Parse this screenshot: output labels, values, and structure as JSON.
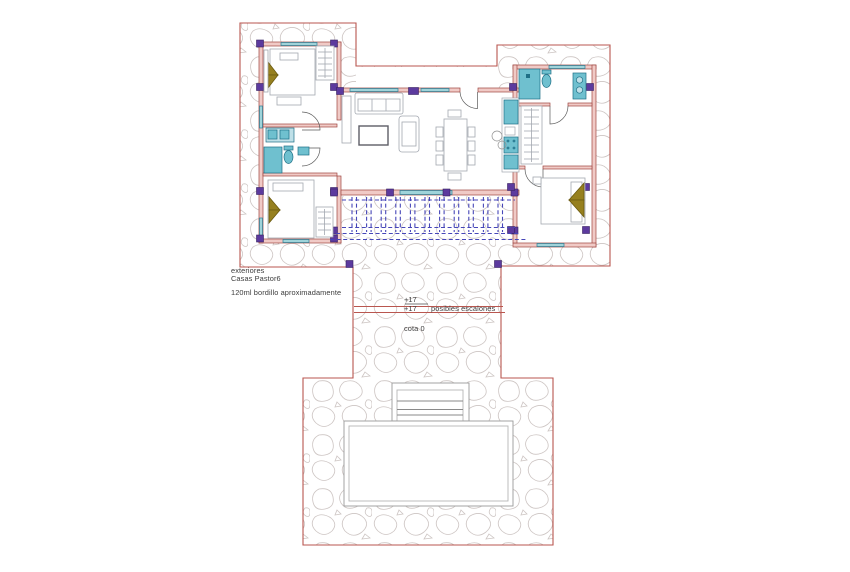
{
  "drawing": {
    "annotations": {
      "area_label_line1": "exteriores",
      "area_label_line2": "Casas Pastor6",
      "curb_note": "120ml bordillo aproximadamente",
      "level_mark_upper": "+17",
      "level_mark_lower": "+17",
      "steps_note": "posibles escalones",
      "datum_label": "cota 0"
    },
    "palette": {
      "terrace_boundary_red": "#b9564f",
      "wall_fill_pink": "#f0cac6",
      "wall_edge_red": "#9e453f",
      "column_purple": "#5c3a9e",
      "fixture_teal": "#6fc0cf",
      "window_teal": "#9fd4da",
      "pergola_blue": "#4646b8",
      "stone_outline_gray": "#cdc5c3",
      "furniture_gray": "#a3a8b0",
      "pillow_olive": "#96801f",
      "pool_gray": "#9a9a9a"
    }
  }
}
